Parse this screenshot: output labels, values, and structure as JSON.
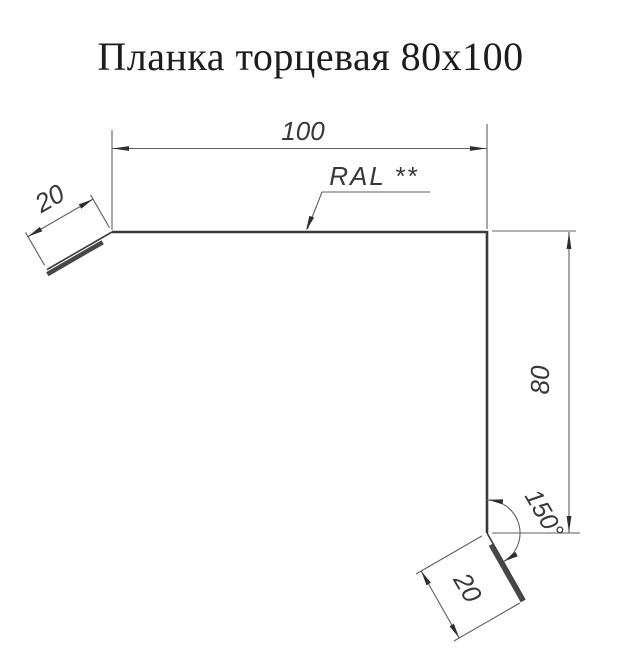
{
  "title": "Планка торцевая 80x100",
  "labels": {
    "width": "100",
    "height": "80",
    "flange_top": "20",
    "flange_bottom": "20",
    "angle": "150°",
    "coating": "RAL **"
  },
  "colors": {
    "background": "#ffffff",
    "profile_line": "#3a3a3a",
    "dimension_line": "#5f5f5f",
    "text": "#383838"
  }
}
